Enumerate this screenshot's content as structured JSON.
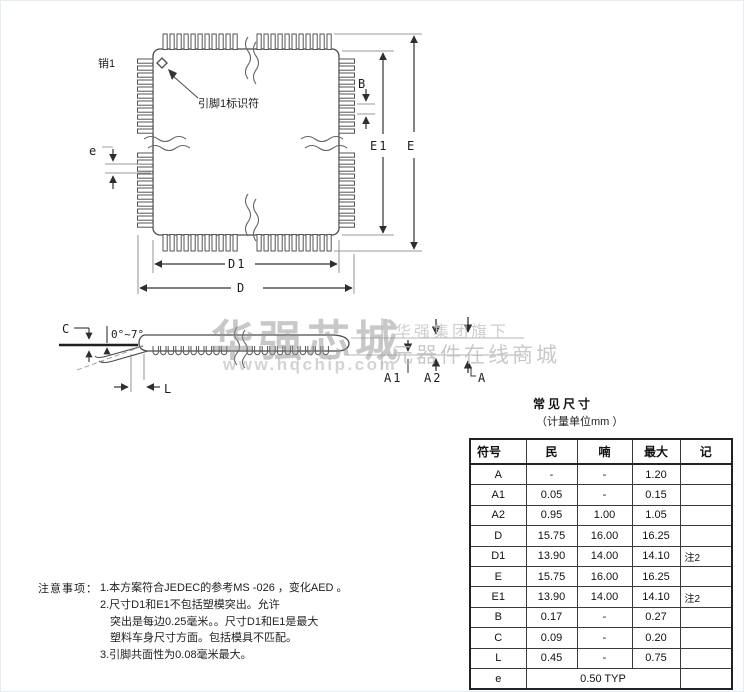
{
  "colors": {
    "line": "#4a4a4a",
    "dimension": "#333333",
    "extension": "#999999",
    "watermark": "#9a9a9a"
  },
  "top_view": {
    "pin1_label": "销1",
    "pin1_id_label": "引脚1标识符",
    "dims": {
      "e": "e",
      "B": "B",
      "E1": "E1",
      "E": "E",
      "D1": "D1",
      "D": "D"
    }
  },
  "side_view": {
    "dims": {
      "C": "C",
      "angle": "0°~7°",
      "L": "L",
      "A1": "A1",
      "A2": "A2",
      "A": "A"
    }
  },
  "watermark": {
    "brand": "华强芯城",
    "url": "www.hqchip.com",
    "group": "华强集团旗下",
    "mall": "元器件在线商城"
  },
  "table": {
    "title": "常见尺寸",
    "subtitle": "（计量单位mm ）",
    "headers": [
      "符号",
      "民",
      "喃",
      "最大",
      "记"
    ],
    "col_widths": [
      56,
      51,
      55,
      48,
      52
    ],
    "rows": [
      {
        "symbol": "A",
        "min": "-",
        "nom": "-",
        "max": "1.20",
        "note": ""
      },
      {
        "symbol": "A1",
        "min": "0.05",
        "nom": "-",
        "max": "0.15",
        "note": ""
      },
      {
        "symbol": "A2",
        "min": "0.95",
        "nom": "1.00",
        "max": "1.05",
        "note": ""
      },
      {
        "symbol": "D",
        "min": "15.75",
        "nom": "16.00",
        "max": "16.25",
        "note": ""
      },
      {
        "symbol": "D1",
        "min": "13.90",
        "nom": "14.00",
        "max": "14.10",
        "note": "注2"
      },
      {
        "symbol": "E",
        "min": "15.75",
        "nom": "16.00",
        "max": "16.25",
        "note": ""
      },
      {
        "symbol": "E1",
        "min": "13.90",
        "nom": "14.00",
        "max": "14.10",
        "note": "注2"
      },
      {
        "symbol": "B",
        "min": "0.17",
        "nom": "-",
        "max": "0.27",
        "note": ""
      },
      {
        "symbol": "C",
        "min": "0.09",
        "nom": "-",
        "max": "0.20",
        "note": ""
      },
      {
        "symbol": "L",
        "min": "0.45",
        "nom": "-",
        "max": "0.75",
        "note": ""
      },
      {
        "symbol": "e",
        "typ": "0.50 TYP",
        "note": ""
      }
    ]
  },
  "notes": {
    "label": "注意事项：",
    "lines": [
      "1.本方案符合JEDEC的参考MS -026 ，变化AED 。",
      "2.尺寸D1和E1不包括塑模突出。允许",
      "突出是每边0.25毫米。。尺寸D1和E1是最大",
      "塑料车身尺寸方面。包括模具不匹配。",
      "3.引脚共面性为0.08毫米最大。"
    ]
  }
}
